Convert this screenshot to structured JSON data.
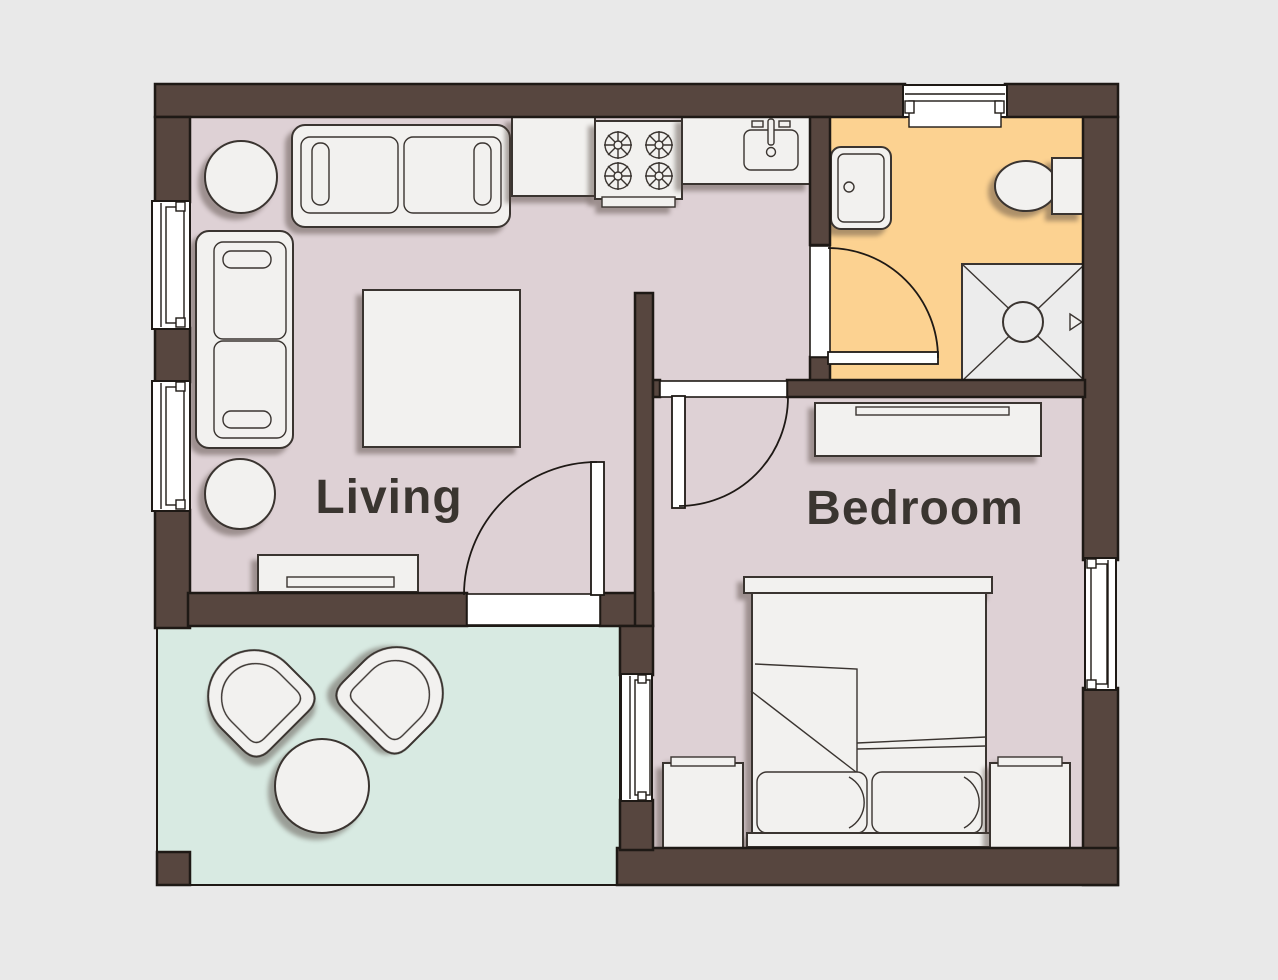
{
  "title": "One-bedroom apartment floor plan",
  "labels": {
    "living": "Living",
    "bedroom": "Bedroom"
  },
  "colors": {
    "background": "#e9e9e9",
    "wall": "#57463f",
    "outline": "#1e1915",
    "floor_main": "#ded1d5",
    "floor_bathroom": "#fcd291",
    "floor_patio": "#d8eae2",
    "furniture_fill": "#f2f1ef",
    "furniture_outline": "#3a3430",
    "shower_fill": "#ececec",
    "label_text": "#3a3530"
  },
  "rooms": [
    {
      "name": "living-room",
      "label": "Living",
      "floor": "mauve",
      "furniture": [
        "three-seat-sofa",
        "two-seat-sofa",
        "coffee-table",
        "round-side-table-upper",
        "round-side-table-lower",
        "tv-console"
      ]
    },
    {
      "name": "kitchen-area",
      "label": "",
      "floor": "mauve",
      "furniture": [
        "kitchen-counter",
        "stove-four-burners",
        "kitchen-sink-counter"
      ]
    },
    {
      "name": "bathroom",
      "label": "",
      "floor": "orange",
      "furniture": [
        "bathroom-sink",
        "toilet",
        "shower"
      ]
    },
    {
      "name": "bedroom",
      "label": "Bedroom",
      "floor": "mauve",
      "furniture": [
        "dresser",
        "double-bed",
        "pillow-left",
        "pillow-right",
        "nightstand-left",
        "nightstand-right"
      ]
    },
    {
      "name": "patio",
      "label": "",
      "floor": "mint",
      "furniture": [
        "patio-chair-left",
        "patio-chair-right",
        "patio-round-table"
      ]
    }
  ],
  "openings": {
    "windows": [
      "living-left-upper",
      "living-left-lower",
      "bathroom-top",
      "bedroom-right",
      "bedroom-patio-side"
    ],
    "doors": [
      "bathroom-door",
      "bedroom-door",
      "living-patio-door"
    ]
  }
}
